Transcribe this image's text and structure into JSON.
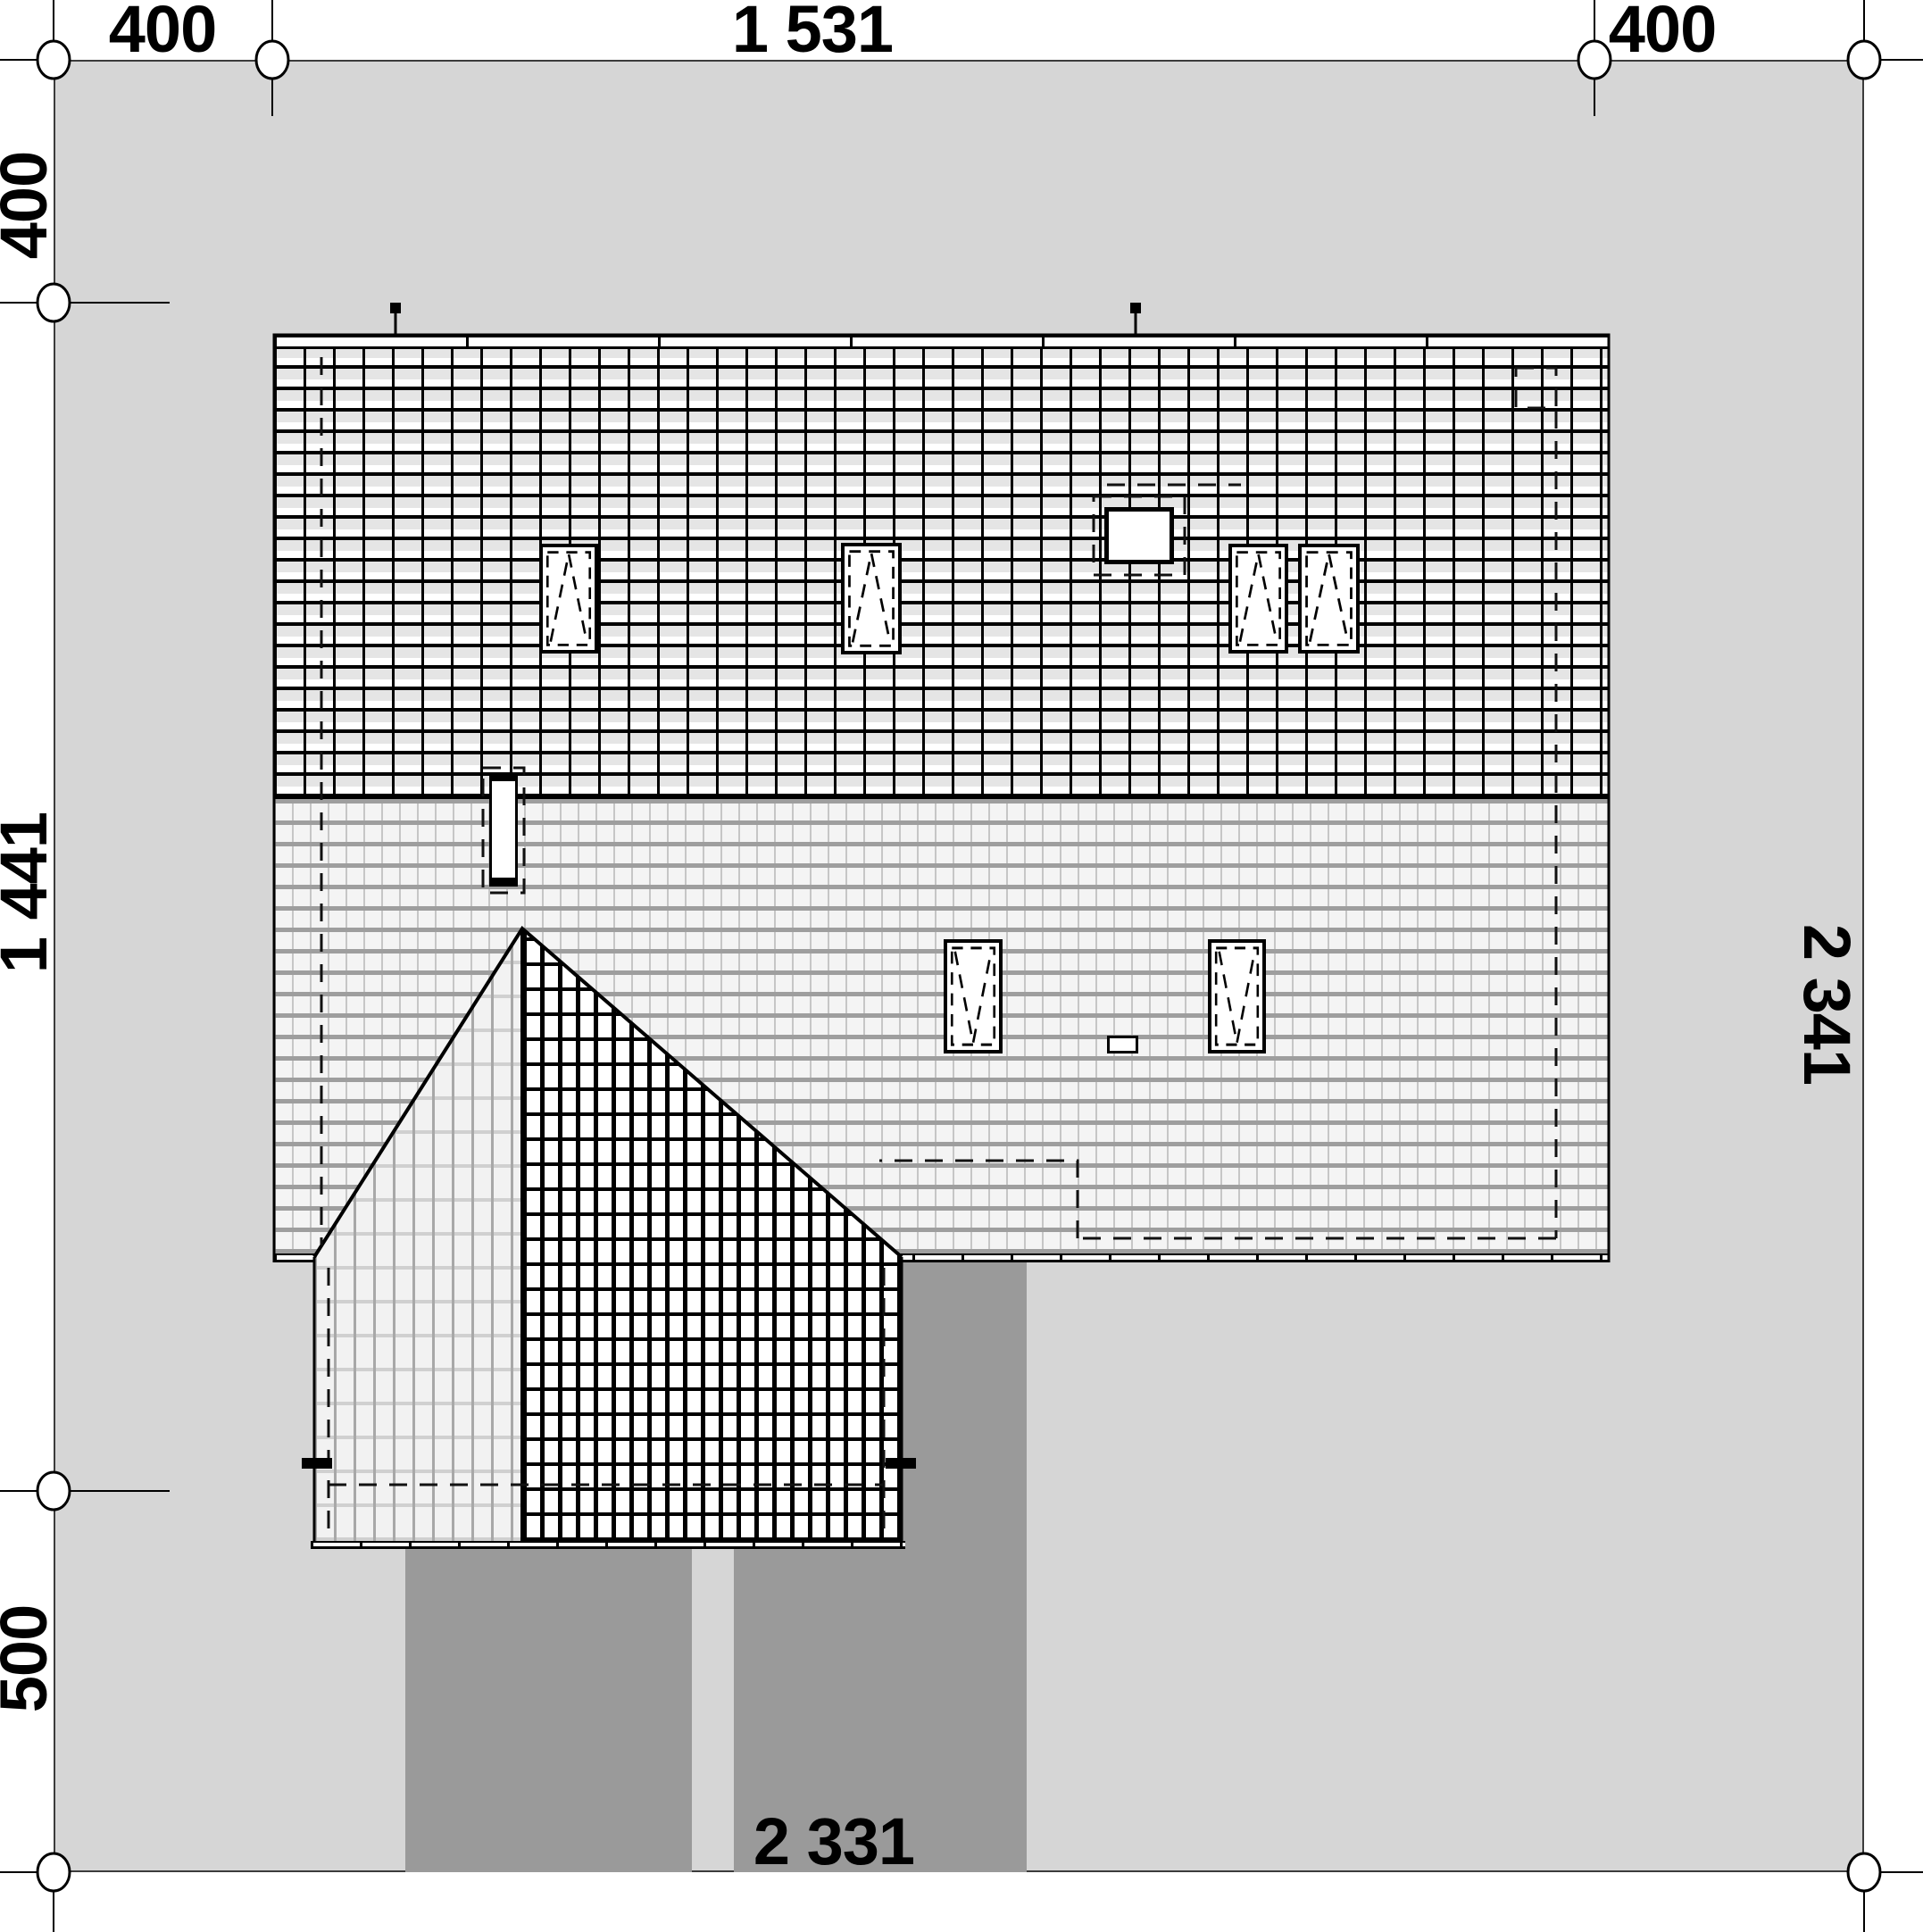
{
  "drawing": {
    "type": "site-roof-plan",
    "dimensions": {
      "top": [
        "400",
        "1 531",
        "400"
      ],
      "left": [
        "400",
        "1 441",
        "500"
      ],
      "right": [
        "2 341"
      ],
      "bottom": [
        "2 331"
      ]
    }
  },
  "colors": {
    "background": "#ffffff",
    "plot": "#d6d6d6",
    "driveway": "#9a9a9a",
    "line": "#000000"
  }
}
